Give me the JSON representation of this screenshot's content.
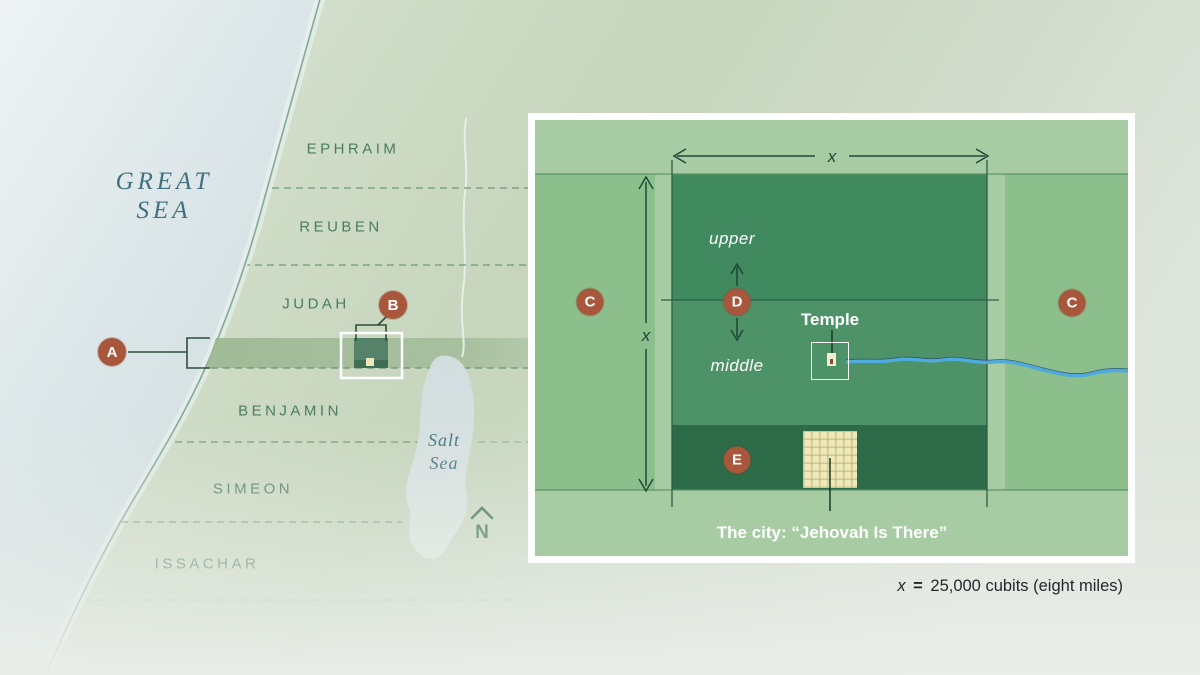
{
  "map": {
    "great_sea": {
      "line1": "GREAT",
      "line2": "SEA"
    },
    "salt_sea": {
      "line1": "Salt",
      "line2": "Sea"
    },
    "tribes": [
      "EPHRAIM",
      "REUBEN",
      "JUDAH",
      "BENJAMIN",
      "SIMEON",
      "ISSACHAR"
    ],
    "compass": {
      "label": "N"
    },
    "markers": {
      "a": "A",
      "b": "B"
    }
  },
  "inset": {
    "markers": {
      "c": "C",
      "d": "D",
      "e": "E"
    },
    "labels": {
      "upper": "upper",
      "middle": "middle",
      "temple": "Temple",
      "city": "The city: “Jehovah Is There”",
      "dim": "x"
    }
  },
  "legend": {
    "x": "x",
    "eq": "=",
    "rest": "25,000 cubits (eight miles)"
  },
  "colors": {
    "marker_circle": "#a8573c",
    "river_blue": "#4faade",
    "city_square_cream": "#efe9ba",
    "sea_text_teal": "#41707f",
    "tribe_text_green": "#4b7c61",
    "inset_upper_green": "#41895f",
    "inset_middle_green": "#4e9268",
    "inset_city_strip_green": "#2d6a48",
    "great_sea_fill": "#d3dfe2",
    "land_fill": "#c9d8c1"
  }
}
